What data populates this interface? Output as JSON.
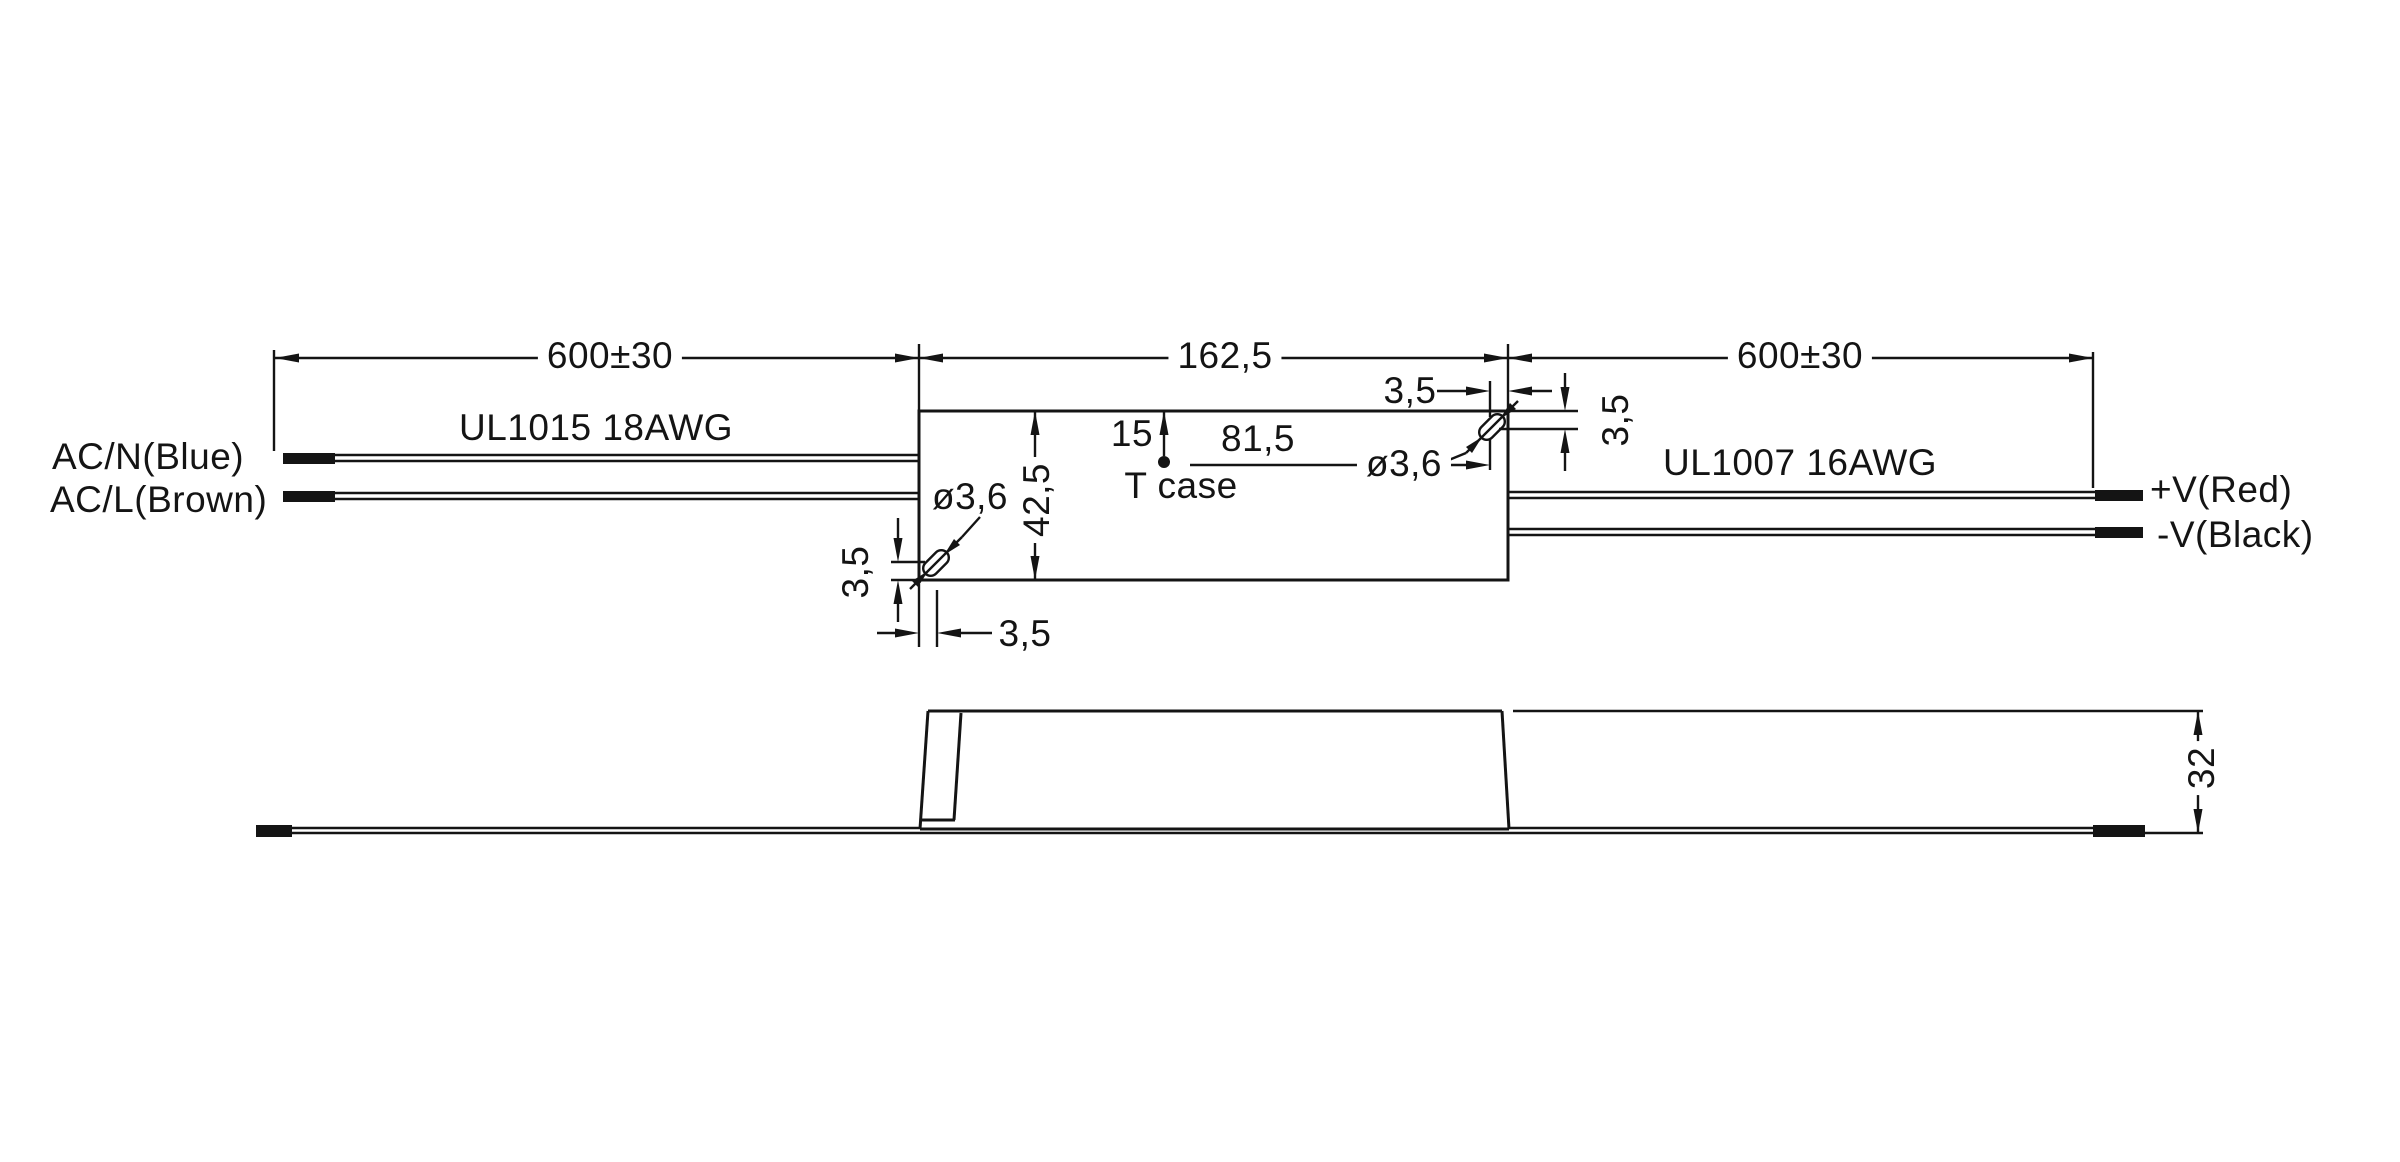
{
  "colors": {
    "line": "#141414",
    "background": "#ffffff"
  },
  "top_view": {
    "labels": {
      "ac_n": "AC/N(Blue)",
      "ac_l": "AC/L(Brown)",
      "input_wire_spec": "UL1015 18AWG",
      "output_wire_spec": "UL1007 16AWG",
      "v_plus": "+V(Red)",
      "v_minus": "-V(Black)",
      "tcase": "T case"
    },
    "dimensions": {
      "input_wire_length": "600±30",
      "case_length": "162,5",
      "output_wire_length": "600±30",
      "case_width": "42,5",
      "tcase_from_top": "15",
      "tcase_to_hole": "81,5",
      "hole_dia_right": "ø3,6",
      "hole_dia_left": "ø3,6",
      "hole_offset_x_right": "3,5",
      "hole_offset_y_right": "3,5",
      "hole_offset_y_left": "3,5",
      "hole_offset_x_left": "3,5"
    }
  },
  "side_view": {
    "dimensions": {
      "case_height": "32"
    }
  }
}
